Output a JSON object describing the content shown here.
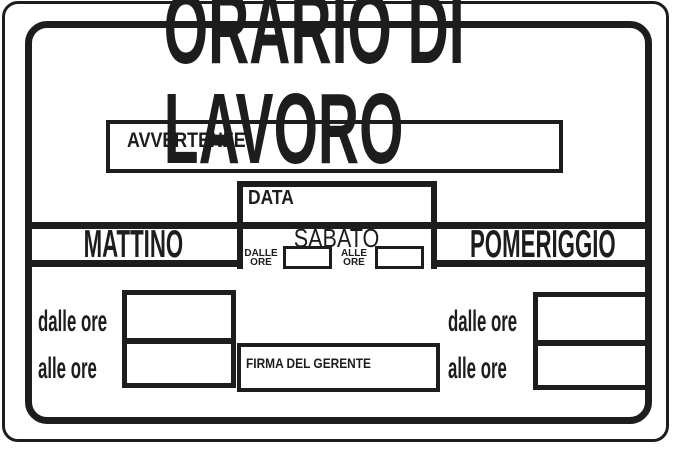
{
  "sign": {
    "title": "ORARIO DI LAVORO",
    "notices_label": "AVVERTENZE",
    "date_label": "DATA",
    "saturday": {
      "heading": "SABATO",
      "from": {
        "line1": "DALLE",
        "line2": "ORE"
      },
      "to": {
        "line1": "ALLE",
        "line2": "ORE"
      }
    },
    "morning": {
      "heading": "MATTINO",
      "from_label": "dalle ore",
      "to_label": "alle ore"
    },
    "afternoon": {
      "heading": "POMERIGGIO",
      "from_label": "dalle ore",
      "to_label": "alle ore"
    },
    "signature_label": "FIRMA DEL GERENTE",
    "colors": {
      "ink": "#1d1d1b",
      "background": "#ffffff"
    }
  }
}
